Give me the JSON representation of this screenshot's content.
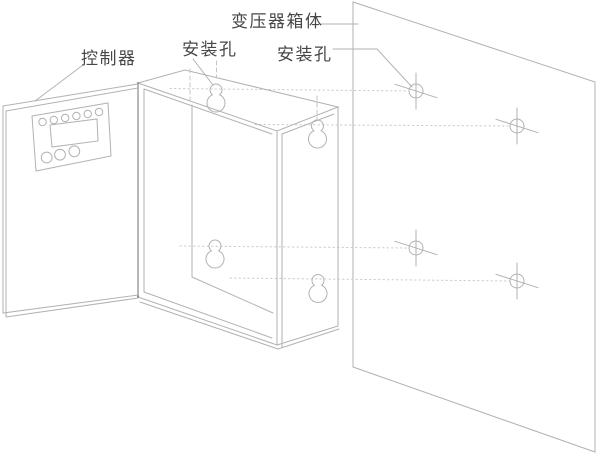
{
  "figure": {
    "kind": "technical-line-drawing",
    "width_px": 600,
    "height_px": 458
  },
  "labels": {
    "controller": "控制器",
    "mounting_hole_cabinet": "安装孔",
    "transformer_box_body": "变压器箱体",
    "mounting_hole_wall": "安装孔"
  },
  "colors": {
    "background": "#ffffff",
    "line": "#b2b2b2",
    "line_dark": "#5f5f5f",
    "dotted_guide": "#cccccc",
    "hidden_dash": "#c4c4c4",
    "text": "#474747"
  },
  "counts": {
    "wall_mounting_holes": 4,
    "cabinet_keyholes": 4,
    "panel_small_buttons": 6,
    "panel_large_buttons": 3
  }
}
